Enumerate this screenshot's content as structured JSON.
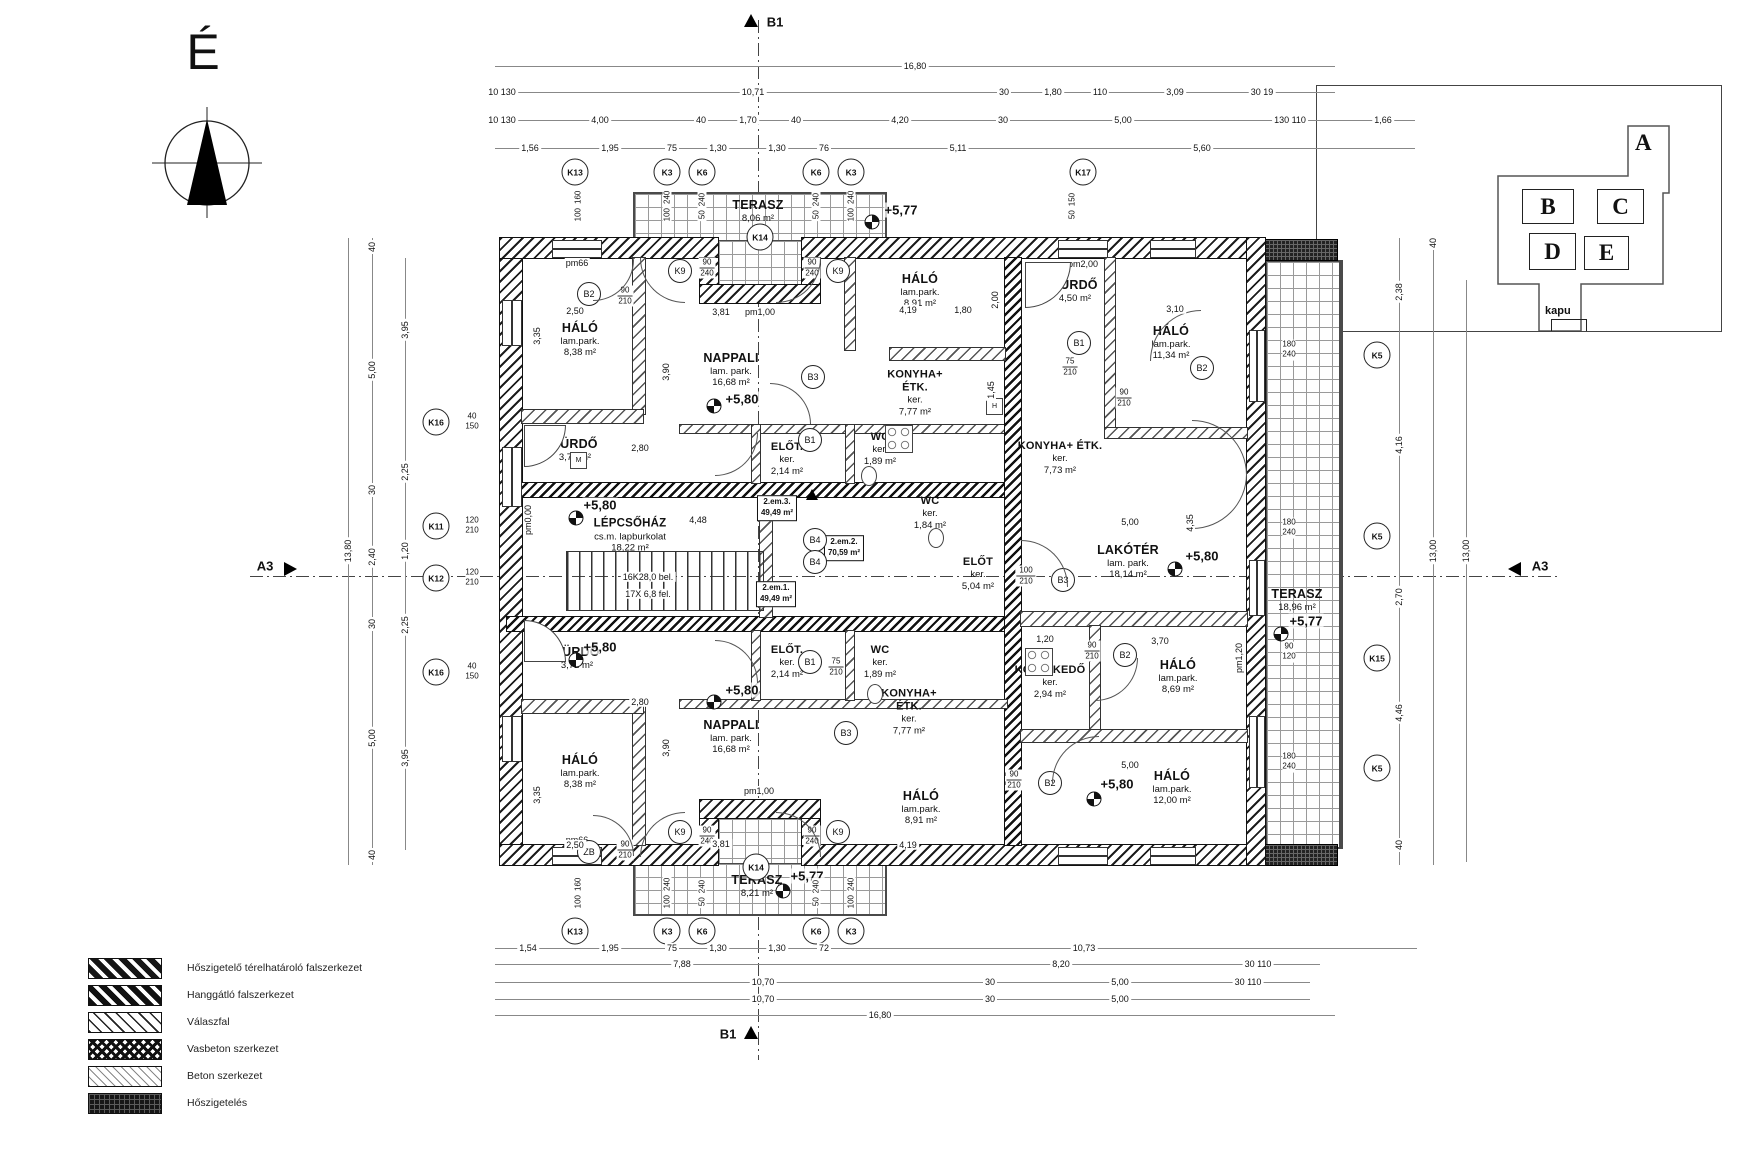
{
  "compass": {
    "label": "É"
  },
  "section_labels": {
    "a3": "A3",
    "b1": "B1"
  },
  "key_plan": {
    "gate": "kapu",
    "buildings": [
      "A",
      "B",
      "C",
      "D",
      "E"
    ]
  },
  "legend": {
    "items": [
      {
        "label": "Hőszigetelő térelhatároló falszerkezet"
      },
      {
        "label": "Hanggátló falszerkezet"
      },
      {
        "label": "Válaszfal"
      },
      {
        "label": "Vasbeton szerkezet"
      },
      {
        "label": "Beton szerkezet"
      },
      {
        "label": "Hőszigetelés"
      }
    ]
  },
  "levels": {
    "floor": "+5,80",
    "terrace": "+5,77"
  },
  "units": [
    {
      "id": "2.em.1.",
      "area": "49,49 m²"
    },
    {
      "id": "2.em.2.",
      "area": "70,59 m²"
    },
    {
      "id": "2.em.3.",
      "area": "49,49 m²"
    }
  ],
  "stair": {
    "name": "LÉPCSŐHÁZ",
    "finish": "cs.m. lapburkolat",
    "area": "18,22 m²",
    "note1": "16K28,0 bel.",
    "note2": "17X 6,8 fel."
  },
  "rooms": [
    {
      "n": "HÁLÓ",
      "f": "lam.park.",
      "a": "8,38 m²"
    },
    {
      "n": "NAPPALI",
      "f": "lam. park.",
      "a": "16,68 m²"
    },
    {
      "n": "FÜRDŐ",
      "a": "3,72 m²"
    },
    {
      "n": "TERASZ",
      "a": "8,06 m²"
    },
    {
      "n": "HÁLÓ",
      "f": "lam.park.",
      "a": "8,91 m²"
    },
    {
      "n": "KONYHA+",
      "n2": "ÉTK.",
      "f": "ker.",
      "a": "7,77 m²"
    },
    {
      "n": "ELŐT.",
      "f": "ker.",
      "a": "2,14 m²"
    },
    {
      "n": "WC",
      "f": "ker.",
      "a": "1,89 m²"
    },
    {
      "n": "FÜRDŐ",
      "a": "4,50 m²"
    },
    {
      "n": "HÁLÓ",
      "f": "lam.park.",
      "a": "11,34 m²"
    },
    {
      "n": "KONYHA+ ÉTK.",
      "f": "ker.",
      "a": "7,73 m²"
    },
    {
      "n": "WC",
      "f": "ker.",
      "a": "1,84 m²"
    },
    {
      "n": "ELŐT",
      "f": "ker.",
      "a": "5,04 m²"
    },
    {
      "n": "LAKÓTÉR",
      "f": "lam. park.",
      "a": "18,14 m²"
    },
    {
      "n": "TERASZ",
      "a": "18,96 m²"
    },
    {
      "n": "KÖZLEKEDŐ",
      "f": "ker.",
      "a": "2,94 m²"
    },
    {
      "n": "HÁLÓ",
      "f": "lam.park.",
      "a": "8,69 m²"
    },
    {
      "n": "HÁLÓ",
      "f": "lam.park.",
      "a": "12,00 m²"
    },
    {
      "n": "FÜRDŐ",
      "a": "3,72 m²"
    },
    {
      "n": "ELŐT.",
      "f": "ker.",
      "a": "2,14 m²"
    },
    {
      "n": "WC",
      "f": "ker.",
      "a": "1,89 m²"
    },
    {
      "n": "KONYHA+",
      "n2": "ÉTK.",
      "f": "ker.",
      "a": "7,77 m²"
    },
    {
      "n": "NAPPALI",
      "f": "lam. park.",
      "a": "16,68 m²"
    },
    {
      "n": "HÁLÓ",
      "f": "lam.park.",
      "a": "8,38 m²"
    },
    {
      "n": "HÁLÓ",
      "f": "lam.park.",
      "a": "8,91 m²"
    },
    {
      "n": "TERASZ",
      "a": "8,21 m²"
    }
  ],
  "appliances": {
    "washer": "M",
    "fridge": "H"
  },
  "wall_marks": {
    "pm66": "pm66",
    "pm100": "pm1,00",
    "pm200": "pm2,00",
    "pm000": "pm0,00",
    "pm120": "pm1,20"
  },
  "grid": {
    "top": [
      "K13",
      "K3",
      "K6",
      "K6",
      "K3",
      "K17"
    ],
    "bottom": [
      "K13",
      "K3",
      "K6",
      "K6",
      "K3"
    ],
    "left": [
      "K16",
      "K11",
      "K12",
      "K16"
    ],
    "right": [
      "K5",
      "K5",
      "K15",
      "K5"
    ],
    "terrace": [
      "K14",
      "K14"
    ]
  },
  "doors": [
    {
      "t": "B2",
      "s1": "90",
      "s2": "210"
    },
    {
      "t": "K9",
      "s1": "90",
      "s2": "240"
    },
    {
      "t": "K9",
      "s1": "90",
      "s2": "240"
    },
    {
      "t": "B2",
      "s1": "90",
      "s2": "210"
    },
    {
      "t": "B1",
      "s1": "75",
      "s2": "210"
    },
    {
      "t": "B3"
    },
    {
      "t": "B1"
    },
    {
      "t": "B4"
    },
    {
      "t": "B4"
    },
    {
      "t": "B3",
      "s1": "100",
      "s2": "210"
    },
    {
      "t": "B2",
      "s1": "90",
      "s2": "210"
    },
    {
      "t": "B2",
      "s1": "90",
      "s2": "210"
    },
    {
      "t": "B1",
      "s1": "75",
      "s2": "210"
    },
    {
      "t": "B3"
    },
    {
      "t": "ZB",
      "s1": "90",
      "s2": "210"
    },
    {
      "t": "K9",
      "s1": "90",
      "s2": "240"
    },
    {
      "t": "K9",
      "s1": "90",
      "s2": "240"
    }
  ],
  "openings": {
    "top": [
      {
        "a": "100",
        "b": "160"
      },
      {
        "a": "100",
        "b": "240"
      },
      {
        "a": "50",
        "b": "240"
      },
      {
        "a": "50",
        "b": "240"
      },
      {
        "a": "100",
        "b": "240"
      },
      {
        "a": "50",
        "b": "150"
      }
    ],
    "bottom": [
      {
        "a": "100",
        "b": "160"
      },
      {
        "a": "100",
        "b": "240"
      },
      {
        "a": "50",
        "b": "240"
      },
      {
        "a": "50",
        "b": "240"
      },
      {
        "a": "100",
        "b": "240"
      }
    ],
    "left": [
      {
        "a": "40",
        "b": "150"
      },
      {
        "a": "120",
        "b": "210"
      },
      {
        "a": "120",
        "b": "210"
      },
      {
        "a": "40",
        "b": "150"
      }
    ],
    "right": [
      {
        "a": "180",
        "b": "240"
      },
      {
        "a": "180",
        "b": "240"
      },
      {
        "a": "90",
        "b": "120"
      },
      {
        "a": "180",
        "b": "240"
      }
    ]
  },
  "dims": {
    "t1": [
      "16,80"
    ],
    "t2": [
      "10 130",
      "10,71",
      "30",
      "1,80",
      "110",
      "3,09",
      "30 19"
    ],
    "t3": [
      "10 130",
      "4,00",
      "40",
      "1,70",
      "40",
      "4,20",
      "30",
      "5,00",
      "130 110",
      "1,66"
    ],
    "t4": [
      "1,56",
      "1,95",
      "75",
      "1,30",
      "1,30",
      "76",
      "5,11",
      "5,60"
    ],
    "b1": [
      "1,54",
      "1,95",
      "75",
      "1,30",
      "1,30",
      "72",
      "10,73"
    ],
    "b2": [
      "7,88",
      "8,20",
      "30 110"
    ],
    "b3": [
      "10,70",
      "30",
      "5,00",
      "30 110"
    ],
    "b4": [
      "10,70",
      "30",
      "5,00"
    ],
    "b5": [
      "16,80"
    ],
    "l1": [
      "13,80"
    ],
    "l2": [
      "40",
      "5,00",
      "30",
      "2,40",
      "30",
      "5,00",
      "40"
    ],
    "l3": [
      "3,95",
      "2,25",
      "1,20",
      "2,25",
      "3,95"
    ],
    "r1": [
      "2,38",
      "4,16",
      "2,70",
      "4,46",
      "40"
    ],
    "r2": [
      "40",
      "13,00"
    ],
    "r3": [
      "13,00"
    ],
    "in": [
      "2,50",
      "3,35",
      "3,90",
      "3,81",
      "4,19",
      "3,10",
      "2,00",
      "2,80",
      "4,48",
      "5,00",
      "4,35",
      "1,20",
      "3,70",
      "5,00",
      "2,80",
      "2,50",
      "3,81",
      "4,19",
      "3,35",
      "3,90",
      "1,45",
      "1,80"
    ]
  }
}
